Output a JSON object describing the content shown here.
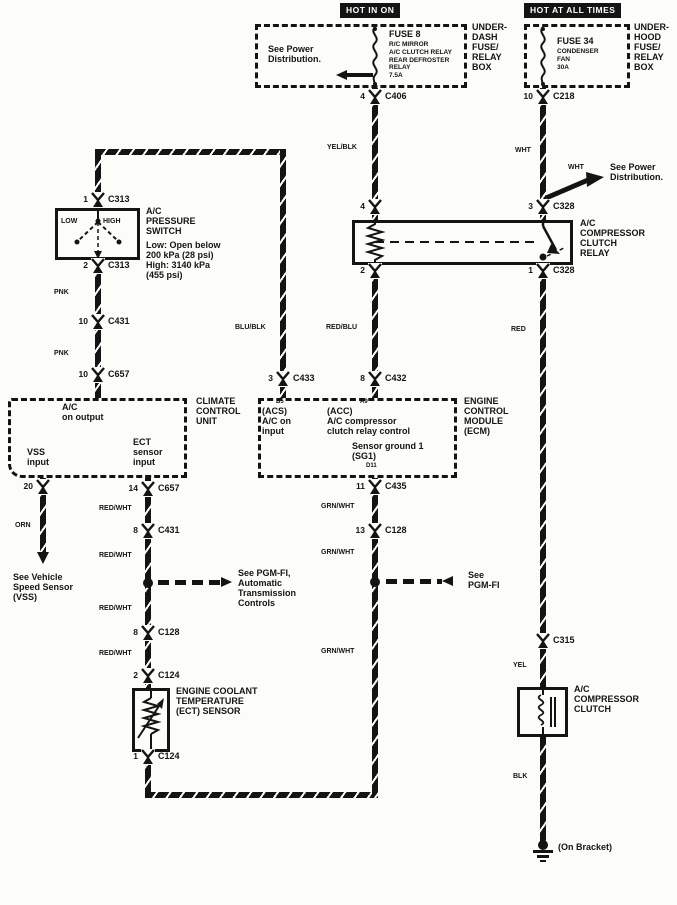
{
  "colors": {
    "ink": "#141414",
    "paper": "#fcfcf9"
  },
  "power": {
    "hot_in_on": "HOT IN ON",
    "hot_at_all_times": "HOT AT ALL TIMES"
  },
  "underdash": {
    "see_power": "See Power\nDistribution.",
    "fuse": "FUSE 8",
    "fuse_detail": "R/C MIRROR\nA/C CLUTCH RELAY\nREAR DEFROSTER\nRELAY\n7.5A",
    "box": "UNDER-\nDASH\nFUSE/\nRELAY\nBOX"
  },
  "underhood": {
    "fuse": "FUSE 34",
    "fuse_detail": "CONDENSER\nFAN\n30A",
    "box": "UNDER-\nHOOD\nFUSE/\nRELAY\nBOX",
    "see_power": "See Power\nDistribution."
  },
  "relay": {
    "label": "A/C\nCOMPRESSOR\nCLUTCH\nRELAY"
  },
  "pressure_switch": {
    "label": "A/C\nPRESSURE\nSWITCH",
    "detail": "Low: Open below\n200 kPa (28 psi)\nHigh: 3140 kPa\n(455 psi)",
    "low": "LOW",
    "high": "HIGH"
  },
  "ccu": {
    "ac_on": "A/C\non output",
    "vss": "VSS\ninput",
    "ect": "ECT\nsensor\ninput",
    "label": "CLIMATE\nCONTROL\nUNIT"
  },
  "ecm": {
    "acs_pin": "B5",
    "acs": "(ACS)\nA/C on\ninput",
    "acc_pin": "A9",
    "acc": "(ACC)\nA/C compressor\nclutch relay control",
    "sg": "Sensor ground 1\n(SG1)",
    "sg_pin": "D11",
    "label": "ENGINE\nCONTROL\nMODULE\n(ECM)"
  },
  "ect_sensor": {
    "label": "ENGINE COOLANT\nTEMPERATURE\n(ECT) SENSOR"
  },
  "clutch": {
    "label": "A/C\nCOMPRESSOR\nCLUTCH"
  },
  "notes": {
    "see_vss": "See Vehicle\nSpeed Sensor\n(VSS)",
    "see_pgmfi_at": "See PGM-FI,\nAutomatic\nTransmission\nControls",
    "see_pgmfi": "See\nPGM-FI",
    "on_bracket": "(On Bracket)"
  },
  "wire_colors": {
    "yel_blk": "YEL/BLK",
    "wht": "WHT",
    "blu_blk": "BLU/BLK",
    "red_blu": "RED/BLU",
    "red": "RED",
    "yel": "YEL",
    "blk": "BLK",
    "pnk": "PNK",
    "orn": "ORN",
    "red_wht": "RED/WHT",
    "grn_wht": "GRN/WHT"
  },
  "connectors": [
    {
      "x": 375,
      "y": 97,
      "pin": "4",
      "label": "C406"
    },
    {
      "x": 543,
      "y": 97,
      "pin": "10",
      "label": "C218"
    },
    {
      "x": 543,
      "y": 207,
      "pin": "3",
      "label": "C328"
    },
    {
      "x": 375,
      "y": 207,
      "pin": "4",
      "label": ""
    },
    {
      "x": 375,
      "y": 271,
      "pin": "2",
      "label": ""
    },
    {
      "x": 543,
      "y": 271,
      "pin": "1",
      "label": "C328"
    },
    {
      "x": 98,
      "y": 200,
      "pin": "1",
      "label": "C313"
    },
    {
      "x": 98,
      "y": 266,
      "pin": "2",
      "label": "C313"
    },
    {
      "x": 98,
      "y": 322,
      "pin": "10",
      "label": "C431"
    },
    {
      "x": 98,
      "y": 375,
      "pin": "10",
      "label": "C657"
    },
    {
      "x": 43,
      "y": 487,
      "pin": "20",
      "label": ""
    },
    {
      "x": 148,
      "y": 489,
      "pin": "14",
      "label": "C657"
    },
    {
      "x": 148,
      "y": 531,
      "pin": "8",
      "label": "C431"
    },
    {
      "x": 148,
      "y": 633,
      "pin": "8",
      "label": "C128"
    },
    {
      "x": 148,
      "y": 676,
      "pin": "2",
      "label": "C124"
    },
    {
      "x": 148,
      "y": 757,
      "pin": "1",
      "label": "C124"
    },
    {
      "x": 375,
      "y": 487,
      "pin": "11",
      "label": "C435"
    },
    {
      "x": 375,
      "y": 531,
      "pin": "13",
      "label": "C128"
    },
    {
      "x": 375,
      "y": 379,
      "pin": "8",
      "label": "C432"
    },
    {
      "x": 283,
      "y": 379,
      "pin": "3",
      "label": "C433"
    },
    {
      "x": 543,
      "y": 641,
      "pin": "",
      "label": "C315"
    }
  ]
}
